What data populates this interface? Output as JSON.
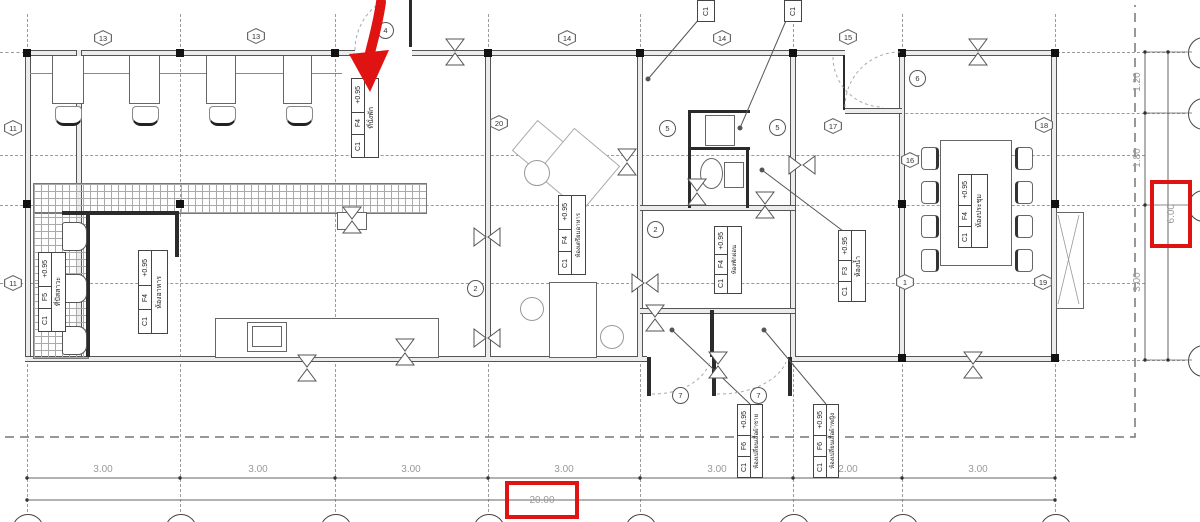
{
  "drawing": {
    "type": "architectural-floor-plan",
    "highlight_color": "#e01313"
  },
  "dims": {
    "bottom": {
      "segments": [
        "3.00",
        "3.00",
        "3.00",
        "3.00",
        "3.00",
        "2.00",
        "3.00"
      ],
      "total": "20.00"
    },
    "right": {
      "segments": [
        "1.20",
        "1.80",
        "3.00"
      ],
      "total": "6.00"
    }
  },
  "grid_bubbles": {
    "hex": [
      "13",
      "13",
      "14",
      "14",
      "15",
      "11",
      "11",
      "20",
      "17",
      "18",
      "16",
      "1",
      "19"
    ],
    "circle": [
      "4",
      "5",
      "5",
      "6",
      "2",
      "2",
      "7",
      "7"
    ]
  },
  "column_tags": [
    "C1",
    "C1"
  ],
  "room_tags": [
    {
      "level": "+0.95",
      "name": "ที่นั่งพัก",
      "floor_code": "F4",
      "column_code": "C1"
    },
    {
      "level": "+0.95",
      "name": "ที่ปัสสาวะ",
      "floor_code": "F5",
      "column_code": "C1"
    },
    {
      "level": "+0.95",
      "name": "ห้องอาหาร",
      "floor_code": "F4",
      "column_code": "C1"
    },
    {
      "level": "+0.95",
      "name": "ห้องเตรียมอาหาร",
      "floor_code": "F4",
      "column_code": "C1"
    },
    {
      "level": "+0.95",
      "name": "ห้องพักผ่อน",
      "floor_code": "F4",
      "column_code": "C1"
    },
    {
      "level": "+0.95",
      "name": "ห้องน้ำ",
      "floor_code": "F3",
      "column_code": "C1"
    },
    {
      "level": "+0.95",
      "name": "ห้องประชุม",
      "floor_code": "F4",
      "column_code": "C1"
    },
    {
      "level": "+0.95",
      "name": "ห้องเปลี่ยนเสื้อผ้าชาย",
      "floor_code": "F6",
      "column_code": "C1"
    },
    {
      "level": "+0.95",
      "name": "ห้องเปลี่ยนเสื้อผ้าหญิง",
      "floor_code": "F6",
      "column_code": "C1"
    }
  ]
}
